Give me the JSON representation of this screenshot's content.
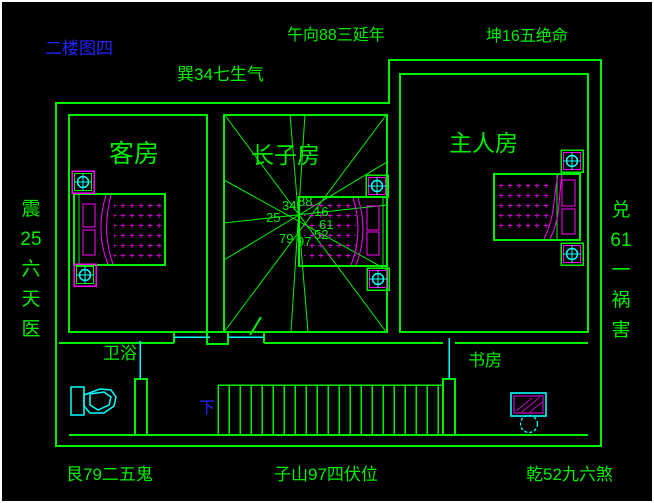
{
  "drawing": {
    "title": "二楼图四",
    "compass": {
      "top_left": "巽34七生气",
      "top_center": "午向88三延年",
      "top_right": "坤16五绝命",
      "left": "震\n25\n六\n天\n医",
      "right": "兑\n61\n一\n祸\n害",
      "bottom_left": "艮79二五鬼",
      "bottom_center": "子山97四伏位",
      "bottom_right": "乾52九六煞"
    },
    "rooms": {
      "guest": "客房",
      "eldest_son": "长子房",
      "master": "主人房",
      "bathroom": "卫浴",
      "study": "书房"
    },
    "stairs_down": "下",
    "center_numbers": {
      "nw": "34",
      "n": "88",
      "ne": "16",
      "w": "25",
      "e": "61",
      "sw": "79",
      "s": "97",
      "se": "52"
    },
    "colors": {
      "wall_green": "#00ee00",
      "text_blue": "#2424ff",
      "fixture_cyan": "#00ffff",
      "furniture_magenta": "#ff00ff",
      "background": "#000000",
      "frame_white": "#ffffff"
    }
  }
}
